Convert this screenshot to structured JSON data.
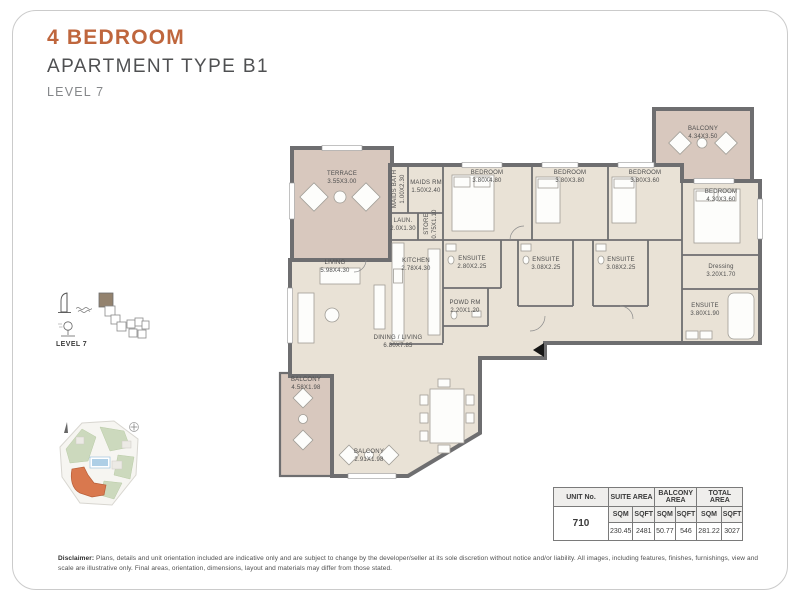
{
  "header": {
    "title": "4 BEDROOM",
    "subtitle": "APARTMENT TYPE B1",
    "level": "LEVEL 7"
  },
  "sidebar": {
    "level_label": "LEVEL 7"
  },
  "colors": {
    "accent_orange": "#bf663d",
    "wall_gray": "#6e6e70",
    "interior_beige": "#e9e2d6",
    "outdoor_pink": "#d8c8be",
    "map_highlight_orange": "#d9784e"
  },
  "floorplan": {
    "rooms": {
      "terrace": {
        "label": "TERRACE",
        "dims": "3.55X3.00"
      },
      "balcony_top": {
        "label": "BALCONY",
        "dims": "4.34X3.50"
      },
      "maids_rm": {
        "label": "MAIDS RM",
        "dims": "1.50X2.40"
      },
      "maids_bath": {
        "label": "MAIDS BATH",
        "dims": "1.00X2.30"
      },
      "laundry": {
        "label": "LAUN.",
        "dims": "2.0X1.30"
      },
      "store": {
        "label": "STORE",
        "dims": "0.75X1.10"
      },
      "bedroom1": {
        "label": "BEDROOM",
        "dims": "3.80X4.80"
      },
      "bedroom2": {
        "label": "BEDROOM",
        "dims": "3.80X3.80"
      },
      "bedroom3": {
        "label": "BEDROOM",
        "dims": "3.80X3.60"
      },
      "bedroom4": {
        "label": "BEDROOM",
        "dims": "4.30X3.60"
      },
      "ensuite1": {
        "label": "ENSUITE",
        "dims": "2.80X2.25"
      },
      "ensuite2": {
        "label": "ENSUITE",
        "dims": "3.08X2.25"
      },
      "ensuite3": {
        "label": "ENSUITE",
        "dims": "3.08X2.25"
      },
      "dressing": {
        "label": "Dressing",
        "dims": "3.20X1.70"
      },
      "master_ensuite": {
        "label": "ENSUITE",
        "dims": "3.80X1.90"
      },
      "living": {
        "label": "LIVING",
        "dims": "5.98X4.30"
      },
      "kitchen": {
        "label": "KITCHEN",
        "dims": "2.78X4.30"
      },
      "powder": {
        "label": "POWD RM",
        "dims": "2.20X1.20"
      },
      "dining": {
        "label": "DINING / LIVING",
        "dims": "6.80X7.85"
      },
      "balcony_left": {
        "label": "BALCONY",
        "dims": "4.58X1.98"
      },
      "balcony_bottom": {
        "label": "BALCONY",
        "dims": "2.91X1.98"
      }
    }
  },
  "area_table": {
    "col_unit": "UNIT No.",
    "col_suite": "SUITE AREA",
    "col_balcony": "BALCONY AREA",
    "col_total": "TOTAL AREA",
    "sqm": "SQM",
    "sqft": "SQFT",
    "unit_no": "710",
    "suite_sqm": "230.45",
    "suite_sqft": "2481",
    "balcony_sqm": "50.77",
    "balcony_sqft": "546",
    "total_sqm": "281.22",
    "total_sqft": "3027"
  },
  "disclaimer": {
    "label": "Disclaimer:",
    "text": " Plans, details and unit orientation included are indicative only and are subject to change by the developer/seller at its sole discretion without notice and/or liability. All images, including features, finishes, furnishings, view and scale are illustrative only. Final areas, orientation, dimensions, layout and materials may differ from those stated."
  }
}
